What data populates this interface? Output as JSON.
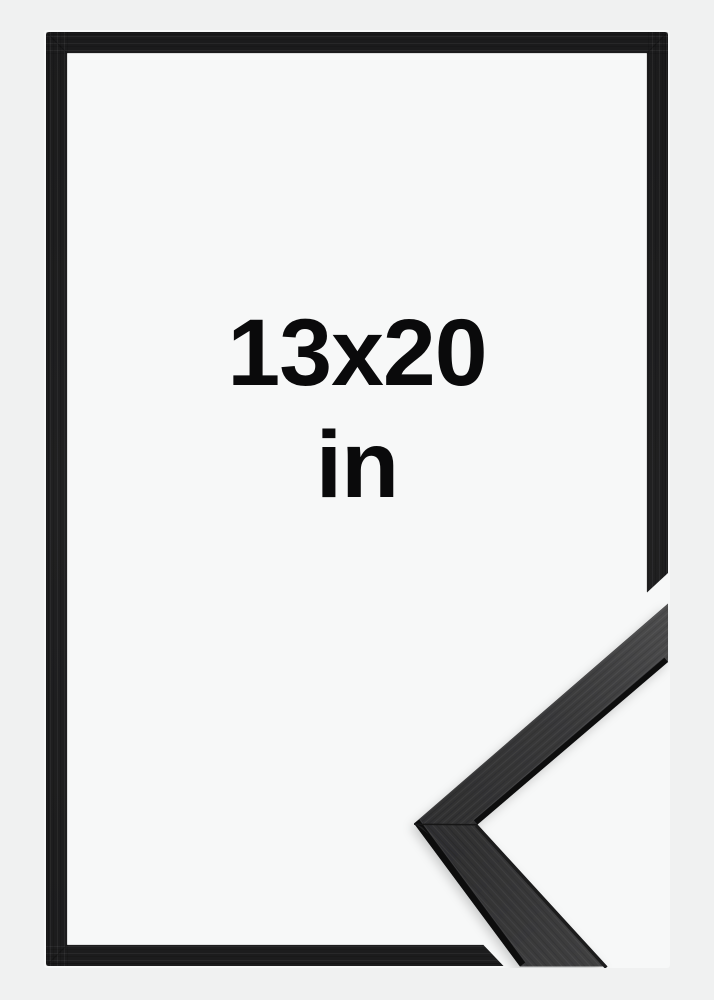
{
  "product_image": {
    "alt": "Black wooden picture frame with corner profile detail",
    "size_label": {
      "dimensions": "13x20",
      "unit": "in"
    },
    "colors": {
      "page_background": "#f0f1f1",
      "photo_background": "#f7f8f8",
      "frame_black": "#1d1e1f",
      "profile_face_dark": "#3a3a3b",
      "profile_edge_black": "#0e0e0f",
      "label_text": "#0a0a0b"
    }
  }
}
